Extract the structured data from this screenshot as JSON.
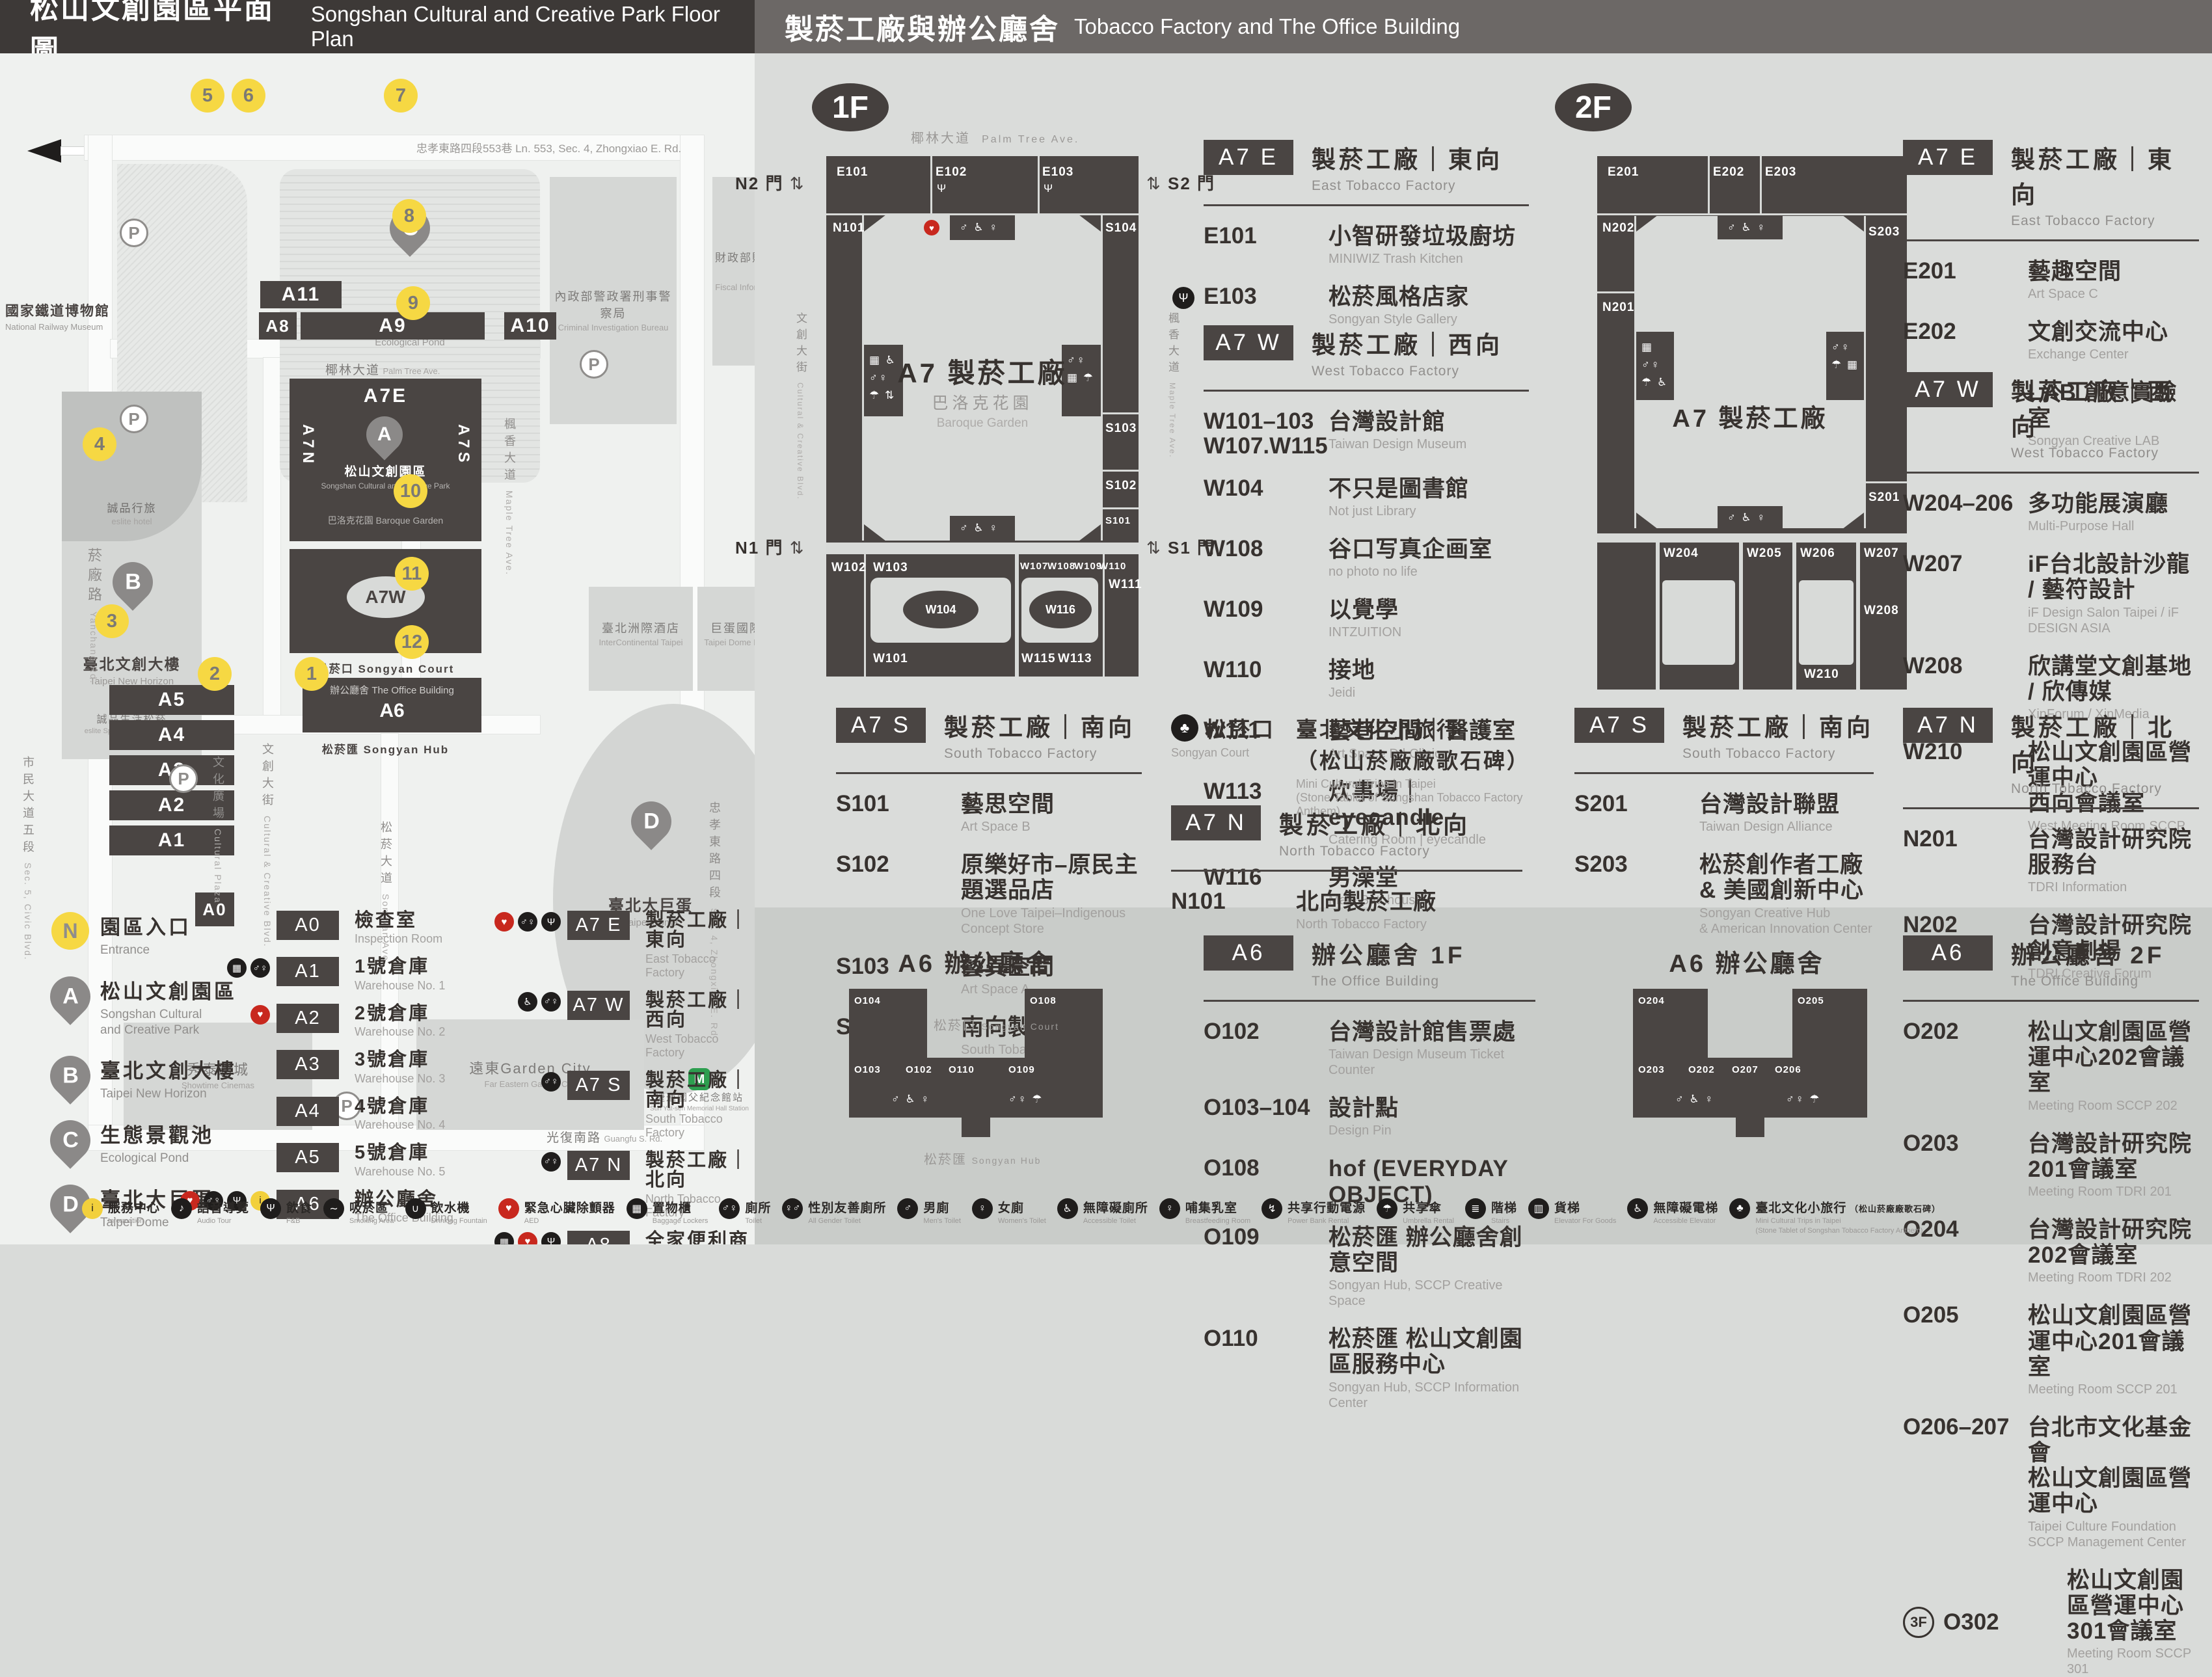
{
  "header": {
    "left_zh": "松山文創園區平面圖",
    "left_en": "Songshan Cultural and Creative Park Floor Plan",
    "right_zh": "製菸工廠與辦公廳舍",
    "right_en": "Tobacco Factory and The Office Building"
  },
  "floors": {
    "f1": "1F",
    "f2": "2F"
  },
  "gates": {
    "n2": "N2 門",
    "s2": "S2 門",
    "n1": "N1 門",
    "s1": "S1 門"
  },
  "plan": {
    "title": "A7 製菸工廠",
    "garden_zh": "巴洛克花園",
    "garden_en": "Baroque Garden"
  },
  "office_plan": {
    "title": "A6 辦公廳舍",
    "court_zh": "松菸口",
    "court_en": "Songyan Court",
    "hub_zh": "松菸匯",
    "hub_en": "Songyan Hub"
  },
  "map": {
    "lane553": "忠孝東路四段553巷  Ln. 553, Sec. 4, Zhongxiao E. Rd.",
    "parking_label": "P",
    "entrances": [
      "1",
      "2",
      "3",
      "4",
      "5",
      "6",
      "7",
      "8",
      "9",
      "10",
      "11",
      "12"
    ],
    "streets": {
      "yanchang_zh": "菸廠路",
      "yanchang_en": "Yanchang Rd.",
      "civic_zh": "市民大道五段",
      "civic_en": "Sec. 5, Civic Blvd.",
      "palm_zh": "椰林大道",
      "palm_en": "Palm Tree Ave.",
      "cultural_blvd_zh": "文創大街",
      "cultural_blvd_en": "Cultural & Creative Blvd.",
      "cultural_plaza_zh": "文化廣場",
      "cultural_plaza_en": "Cultural Plaza",
      "maple_zh": "楓香大道",
      "maple_en": "Maple Tree Ave.",
      "songyan_ave_zh": "松菸大道",
      "songyan_ave_en": "Songyan Ave.",
      "guangfu_zh": "光復南路",
      "guangfu_en": "Guangfu S. Rd.",
      "zhongxiao_zh": "忠孝東路四段",
      "zhongxiao_en": "Sec. 4, Zhongxiao E. Rd."
    },
    "places": {
      "railway_zh": "國家鐵道博物館",
      "railway_en": "National Railway Museum",
      "cib_zh": "內政部警政署刑事警察局",
      "cib_en": "Criminal Investigation Bureau",
      "fia_zh": "財政部財政資訊中心",
      "fia_en": "Fiscal Information Agency, MOF",
      "hotel_zh": "臺北洲際酒店",
      "hotel_en": "InterContinental Taipei",
      "domeintl_zh": "巨蛋國際中心",
      "domeintl_en": "Taipei Dome Intl. Center",
      "eslitehotel_zh": "誠品行旅",
      "eslitehotel_en": "eslite hotel",
      "eslitemall_zh": "誠品生活松菸",
      "eslitemall_en": "eslite Spectrum Songyan Mall",
      "showtime_zh": "秀泰影城",
      "showtime_en": "Showtime Cinemas",
      "garden_zh": "遠東Garden City",
      "garden_en": "Far Eastern Garden City",
      "mrt_zh": "捷運國父紀念館站",
      "mrt_en": "Sun Yat-sen Memorial Hall Station"
    },
    "pins": {
      "a": "A",
      "a_zh": "松山文創園區",
      "a_en": "Songshan Cultural and Creative Park",
      "b": "B",
      "b_zh": "臺北文創大樓",
      "b_en": "Taipei New Horizon",
      "c": "C",
      "c_zh": "生態景觀池",
      "c_en": "Ecological Pond",
      "d": "D",
      "d_zh": "臺北大巨蛋",
      "d_en": "Taipei Dome"
    },
    "blocks": {
      "a0": "A0",
      "a1": "A1",
      "a2": "A2",
      "a3": "A3",
      "a4": "A4",
      "a5": "A5",
      "a6": "A6",
      "a7e": "A7E",
      "a7w": "A7W",
      "a7n": "A7N",
      "a7s": "A7S",
      "a8": "A8",
      "a9": "A9",
      "a10": "A10",
      "a11": "A11"
    },
    "inner": {
      "court": "松菸口 Songyan Court",
      "office_zh": "辦公廳舍",
      "office_en": "The Office Building",
      "hub": "松菸匯 Songyan Hub",
      "baroque_zh": "巴洛克花園",
      "baroque_en": "Baroque Garden"
    }
  },
  "rooms1": {
    "E101": "E101",
    "E102": "E102",
    "E103": "E103",
    "N101": "N101",
    "S104": "S104",
    "S103": "S103",
    "S102": "S102",
    "S101": "S101",
    "W102": "W102",
    "W103": "W103",
    "W104": "W104",
    "W101": "W101",
    "W107": "W107",
    "W108": "W108",
    "W109": "W109",
    "W110": "W110",
    "W116": "W116",
    "W111": "W111",
    "W115": "W115",
    "W113": "W113"
  },
  "rooms2": {
    "E201": "E201",
    "E202": "E202",
    "E203": "E203",
    "N202": "N202",
    "N201": "N201",
    "S203": "S203",
    "S201": "S201",
    "W204": "W204",
    "W205": "W205",
    "W206": "W206",
    "W207": "W207",
    "W208": "W208",
    "W210": "W210"
  },
  "roomsO1": {
    "O104": "O104",
    "O103": "O103",
    "O102": "O102",
    "O110": "O110",
    "O109": "O109",
    "O108": "O108"
  },
  "roomsO2": {
    "O204": "O204",
    "O203": "O203",
    "O202": "O202",
    "O207": "O207",
    "O206": "O206",
    "O205": "O205"
  },
  "sections": {
    "f1e": {
      "badge": "A7 E",
      "zh": "製菸工廠｜東向",
      "en": "East Tobacco Factory",
      "items": [
        {
          "code": "E101",
          "zh": "小智研發垃圾廚坊",
          "en": "MINIWIZ Trash Kitchen"
        },
        {
          "code": "E103",
          "zh": "松菸風格店家",
          "en": "Songyan Style Gallery",
          "icon": "fork"
        }
      ]
    },
    "f1w": {
      "badge": "A7 W",
      "zh": "製菸工廠｜西向",
      "en": "West Tobacco Factory",
      "items": [
        {
          "code": "W101–103",
          "code2": "W107.W115",
          "zh": "台灣設計館",
          "en": "Taiwan Design Museum"
        },
        {
          "code": "W104",
          "zh": "不只是圖書館",
          "en": "Not just Library"
        },
        {
          "code": "W108",
          "zh": "谷口写真企画室",
          "en": "no photo no life"
        },
        {
          "code": "W109",
          "zh": "以覺學",
          "en": "INTZUITION"
        },
        {
          "code": "W110",
          "zh": "接地",
          "en": "Jeidi"
        },
        {
          "code": "W111",
          "zh": "藝巷空間｜醫護室",
          "en": "Art Space D | Clinic"
        },
        {
          "code": "W113",
          "zh": "炊事場｜eyecandle",
          "en": "Catering Room | eyecandle"
        },
        {
          "code": "W116",
          "zh": "男澡堂",
          "en": "Male Bathhouse"
        }
      ]
    },
    "f1s": {
      "badge": "A7 S",
      "zh": "製菸工廠｜南向",
      "en": "South Tobacco Factory",
      "items": [
        {
          "code": "S101",
          "zh": "藝思空間",
          "en": "Art Space B"
        },
        {
          "code": "S102",
          "zh": "原樂好市–原民主題選品店",
          "en": "One Love Taipei–Indigenous Concept Store"
        },
        {
          "code": "S103",
          "zh": "藝異空間",
          "en": "Art Space A"
        },
        {
          "code": "S104",
          "zh": "南向製菸工廠",
          "en": "South Tobacco Factory"
        }
      ]
    },
    "f1court": {
      "code_zh": "松菸口",
      "code_en": "Songyan Court",
      "zh": "臺北文化小旅行",
      "zh2": "（松山菸廠廠歌石碑）",
      "en": "Mini Cultural Trips in Taipei",
      "en2": "(Stone Tablet of Songshan Tobacco Factory Anthem)"
    },
    "f1n": {
      "badge": "A7 N",
      "zh": "製菸工廠｜北向",
      "en": "North Tobacco Factory",
      "items": [
        {
          "code": "N101",
          "zh": "北向製菸工廠",
          "en": "North Tobacco Factory"
        }
      ]
    },
    "o1": {
      "badge": "A6",
      "zh": "辦公廳舍 1F",
      "en": "The Office Building",
      "items": [
        {
          "code": "O102",
          "zh": "台灣設計館售票處",
          "en": "Taiwan Design Museum Ticket Counter"
        },
        {
          "code": "O103–104",
          "zh": "設計點",
          "en": "Design Pin"
        },
        {
          "code": "O108",
          "zh": "hof (EVERYDAY OBJECT)",
          "en": ""
        },
        {
          "code": "O109",
          "zh": "松菸匯 辦公廳舍創意空間",
          "en": "Songyan Hub, SCCP Creative Space"
        },
        {
          "code": "O110",
          "zh": "松菸匯 松山文創園區服務中心",
          "en": "Songyan Hub, SCCP Information Center"
        }
      ]
    },
    "f2e": {
      "badge": "A7 E",
      "zh": "製菸工廠｜東向",
      "en": "East Tobacco Factory",
      "items": [
        {
          "code": "E201",
          "zh": "藝趣空間",
          "en": "Art Space C"
        },
        {
          "code": "E202",
          "zh": "文創交流中心",
          "en": "Exchange Center"
        },
        {
          "code": "E203",
          "zh": "LAB 創意實驗室",
          "en": "Songyan Creative LAB"
        }
      ]
    },
    "f2w": {
      "badge": "A7 W",
      "zh": "製菸工廠｜西向",
      "en": "West Tobacco Factory",
      "items": [
        {
          "code": "W204–206",
          "zh": "多功能展演廳",
          "en": "Multi-Purpose Hall"
        },
        {
          "code": "W207",
          "zh": "iF台北設計沙龍 / 藝符設計",
          "en": "iF Design Salon Taipei / iF DESIGN ASIA"
        },
        {
          "code": "W208",
          "zh": "欣講堂文創基地 / 欣傳媒",
          "en": "XinForum / XinMedia"
        },
        {
          "code": "W210",
          "zh": "松山文創園區營運中心",
          "zh2": "西向會議室",
          "en": "West Meeting Room SCCP"
        }
      ]
    },
    "f2s": {
      "badge": "A7 S",
      "zh": "製菸工廠｜南向",
      "en": "South Tobacco Factory",
      "items": [
        {
          "code": "S201",
          "zh": "台灣設計聯盟",
          "en": "Taiwan Design Alliance"
        },
        {
          "code": "S203",
          "zh": "松菸創作者工廠",
          "zh2": "& 美國創新中心",
          "en": "Songyan Creative Hub",
          "en2": "& American Innovation Center"
        }
      ]
    },
    "f2n": {
      "badge": "A7 N",
      "zh": "製菸工廠｜北向",
      "en": "North Tobacco Factory",
      "items": [
        {
          "code": "N201",
          "zh": "台灣設計研究院 服務台",
          "en": "TDRI Information"
        },
        {
          "code": "N202",
          "zh": "台灣設計研究院 創意劇場",
          "en": "TDRI Creative Forum"
        }
      ]
    },
    "o2": {
      "badge": "A6",
      "zh": "辦公廳舍 2F",
      "en": "The Office Building",
      "items": [
        {
          "code": "O202",
          "zh": "松山文創園區營運中心202會議室",
          "en": "Meeting Room SCCP 202"
        },
        {
          "code": "O203",
          "zh": "台灣設計研究院201會議室",
          "en": "Meeting Room TDRI 201"
        },
        {
          "code": "O204",
          "zh": "台灣設計研究院202會議室",
          "en": "Meeting Room TDRI 202"
        },
        {
          "code": "O205",
          "zh": "松山文創園區營運中心201會議室",
          "en": "Meeting Room SCCP 201"
        },
        {
          "code": "O206–207",
          "zh": "台北市文化基金會",
          "zh2": "松山文創園區營運中心",
          "en": "Taipei Culture Foundation SCCP Management Center"
        },
        {
          "code": "O302",
          "prefix": "3F",
          "zh": "松山文創園區營運中心301會議室",
          "en": "Meeting Room SCCP 301"
        }
      ]
    }
  },
  "legend": {
    "left": [
      {
        "type": "circle",
        "key": "N",
        "zh": "園區入口",
        "en": "Entrance"
      },
      {
        "type": "pin",
        "key": "A",
        "zh": "松山文創園區",
        "en": "Songshan Cultural\nand Creative Park"
      },
      {
        "type": "pin",
        "key": "B",
        "zh": "臺北文創大樓",
        "en": "Taipei New Horizon"
      },
      {
        "type": "pin",
        "key": "C",
        "zh": "生態景觀池",
        "en": "Ecological Pond"
      },
      {
        "type": "pin",
        "key": "D",
        "zh": "臺北大巨蛋",
        "en": "Taipei Dome"
      }
    ],
    "mid": [
      {
        "badge": "A0",
        "zh": "檢查室",
        "en": "Inspection Room",
        "icons": []
      },
      {
        "badge": "A1",
        "zh": "1號倉庫",
        "en": "Warehouse No. 1",
        "icons": [
          "locker",
          "toilet"
        ]
      },
      {
        "badge": "A2",
        "zh": "2號倉庫",
        "en": "Warehouse No. 2",
        "icons": [
          "aed"
        ]
      },
      {
        "badge": "A3",
        "zh": "3號倉庫",
        "en": "Warehouse No. 3",
        "icons": []
      },
      {
        "badge": "A4",
        "zh": "4號倉庫",
        "en": "Warehouse No. 4",
        "icons": []
      },
      {
        "badge": "A5",
        "zh": "5號倉庫",
        "en": "Warehouse No. 5",
        "icons": []
      },
      {
        "badge": "A6",
        "zh": "辦公廳舍",
        "en": "The Office Building",
        "icons": [
          "aed",
          "toilet",
          "fork",
          "info"
        ]
      }
    ],
    "right": [
      {
        "badge": "A7 E",
        "zh": "製菸工廠｜東向",
        "en": "East Tobacco Factory",
        "icons": [
          "aed",
          "toilet",
          "fork"
        ]
      },
      {
        "badge": "A7 W",
        "zh": "製菸工廠｜西向",
        "en": "West Tobacco Factory",
        "icons": [
          "wheelchair",
          "toilet"
        ]
      },
      {
        "badge": "A7 S",
        "zh": "製菸工廠｜南向",
        "en": "South Tobacco Factory",
        "icons": [
          "toilet"
        ]
      },
      {
        "badge": "A7 N",
        "zh": "製菸工廠｜北向",
        "en": "North Tobacco Factory",
        "icons": [
          "toilet"
        ]
      },
      {
        "badge": "A8",
        "zh": "全家便利商店",
        "en": "FamilyMart",
        "icons": [
          "locker",
          "aed",
          "fork"
        ]
      },
      {
        "badge": "A9",
        "zh": "機器修理廠",
        "sub": "ISLAND133 gonna⁺",
        "sub2": "ISLAND133 gonna⁺",
        "en": "The Machine Repair Plant",
        "icons": [
          "fork"
        ]
      },
      {
        "badge": "A10",
        "zh": "鍋爐房",
        "sub": "豆留文青",
        "sub2": "CAMA COFFEE ROASTERS",
        "en": "Boiler Room",
        "icons": [
          "fork"
        ]
      },
      {
        "badge": "A11",
        "zh": "育嬰室",
        "sub": "光一 一個時間",
        "sub2": "GUANG YI TIME",
        "en": "The Nursery Room",
        "icons": [
          "fork"
        ]
      }
    ]
  },
  "footer": [
    {
      "icon": "info",
      "tone": "yellow",
      "zh": "服務中心",
      "en": "Information"
    },
    {
      "icon": "audio",
      "zh": "語音導覽",
      "en": "Audio Tour"
    },
    {
      "icon": "fork",
      "zh": "飲食",
      "en": "F&B"
    },
    {
      "icon": "smoke",
      "zh": "吸菸區",
      "en": "Smoking Area"
    },
    {
      "icon": "water",
      "zh": "飲水機",
      "en": "Drinking Fountain"
    },
    {
      "icon": "aed",
      "tone": "red",
      "zh": "緊急心臟除顫器",
      "en": "AED"
    },
    {
      "icon": "locker",
      "zh": "置物櫃",
      "en": "Baggage Lockers"
    },
    {
      "icon": "toilet",
      "zh": "廁所",
      "en": "Toilet"
    },
    {
      "icon": "allgender",
      "zh": "性別友善廁所",
      "en": "All Gender Toilet"
    },
    {
      "icon": "men",
      "zh": "男廁",
      "en": "Men's Toilet"
    },
    {
      "icon": "women",
      "zh": "女廁",
      "en": "Women's Toilet"
    },
    {
      "icon": "access",
      "zh": "無障礙廁所",
      "en": "Accessible Toilet"
    },
    {
      "icon": "breast",
      "zh": "哺集乳室",
      "en": "Breastfeeding Room"
    },
    {
      "icon": "power",
      "zh": "共享行動電源",
      "en": "Power Bank Rental"
    },
    {
      "icon": "umbrella",
      "zh": "共享傘",
      "en": "Umbrella Rental"
    },
    {
      "icon": "stairs",
      "zh": "階梯",
      "en": "Stairs"
    },
    {
      "icon": "goods",
      "zh": "貨梯",
      "en": "Elevator For Goods"
    },
    {
      "icon": "acelev",
      "zh": "無障礙電梯",
      "en": "Accessible Elevator"
    },
    {
      "icon": "trips",
      "zh": "臺北文化小旅行",
      "sub": "（松山菸廠廠歌石碑）",
      "en": "Mini Cultural Trips in Taipei",
      "en2": "(Stone Tablet of Songshan Tobacco Factory Anthem)"
    }
  ]
}
